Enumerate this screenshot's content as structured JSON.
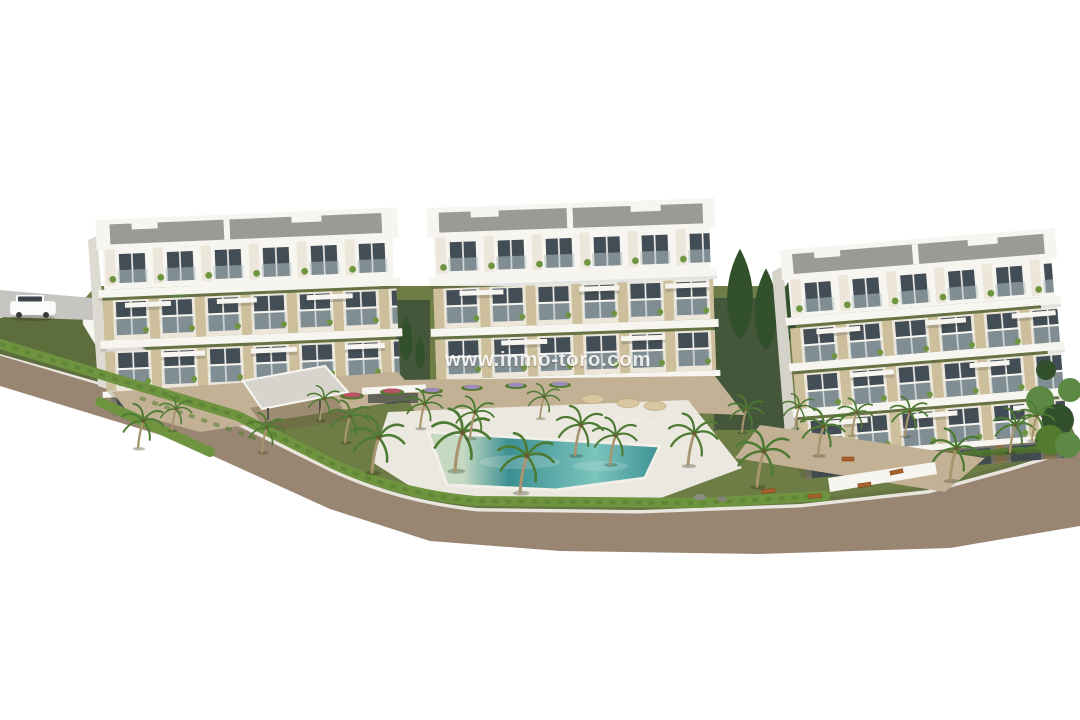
{
  "watermark": {
    "text": "www.inmo-toro.com"
  },
  "palette": {
    "bg": "#ffffff",
    "road": "#998672",
    "asphalt": "#c7c5c1",
    "curb": "#e9e6df",
    "lawn": "#6e7c46",
    "lawn-dark": "#5e6d3c",
    "hedge": "#6f9440",
    "hedge-dark": "#537a2e",
    "path": "#c3b196",
    "deck": "#ebe8e0",
    "pool": "#3c9093",
    "pool-light": "#7cc4bd",
    "pool-shallow": "#c6d9c3",
    "wall": "#ece7da",
    "trim": "#f7f5f0",
    "panel": "#cdbf9c",
    "glass": "#434d56",
    "balcony-glass": "#b3c2c6",
    "roof": "#9c9a96",
    "gwall": "#7b766a",
    "wood": "#8a744f",
    "pergola": "#d7d4cd",
    "palm-frond": "#4e7b33",
    "palm-trunk": "#a8946f",
    "conifer": "#31502b",
    "tree": "#5c8a44",
    "courtyard": "#44573a",
    "umbrella": "#d8c7a0",
    "lounger": "#efece4",
    "bench": "#a8622c",
    "flower-red": "#b85264",
    "flower-purple": "#9c8bba",
    "car": "#fbfbfa",
    "car-glass": "#3b4349",
    "watermark": "#ffffff"
  },
  "scene": {
    "type": "3d-architectural-render",
    "elements": [
      "apartment-building-left",
      "apartment-building-center",
      "apartment-building-right",
      "swimming-pool",
      "pool-deck",
      "pergola",
      "palm-trees",
      "hedges",
      "garden-lawn",
      "perimeter-road",
      "sidewalk",
      "sun-loungers",
      "parasols",
      "benches",
      "flower-beds",
      "white-van",
      "watermark"
    ]
  }
}
